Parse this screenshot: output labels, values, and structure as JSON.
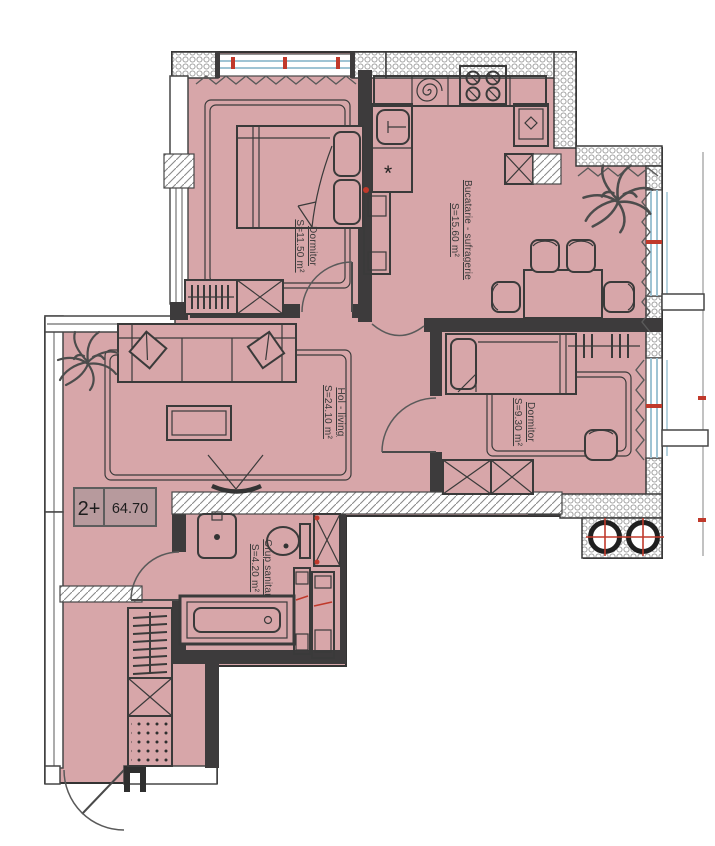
{
  "plan": {
    "unit_badge": {
      "rooms_label": "2+",
      "area_label": "64.70"
    },
    "rooms": [
      {
        "name": "Dormitor",
        "area": "S=11.50 m²"
      },
      {
        "name": "Bucatarie - sufragerie",
        "area": "S=15.60 m²"
      },
      {
        "name": "Hol - living",
        "area": "S=24.10 m²"
      },
      {
        "name": "Dormitor",
        "area": "S=9.30 m²"
      },
      {
        "name": "Grup sanitar",
        "area": "S=4.20 m²"
      }
    ],
    "symbols": {
      "washer": "*"
    },
    "colors": {
      "floor": "#d7a6a9",
      "wall": "#3d3b3c",
      "window_glass": "#9fc4d4",
      "accent_red": "#c0392b",
      "badge_fill": "#b79a9d"
    }
  }
}
